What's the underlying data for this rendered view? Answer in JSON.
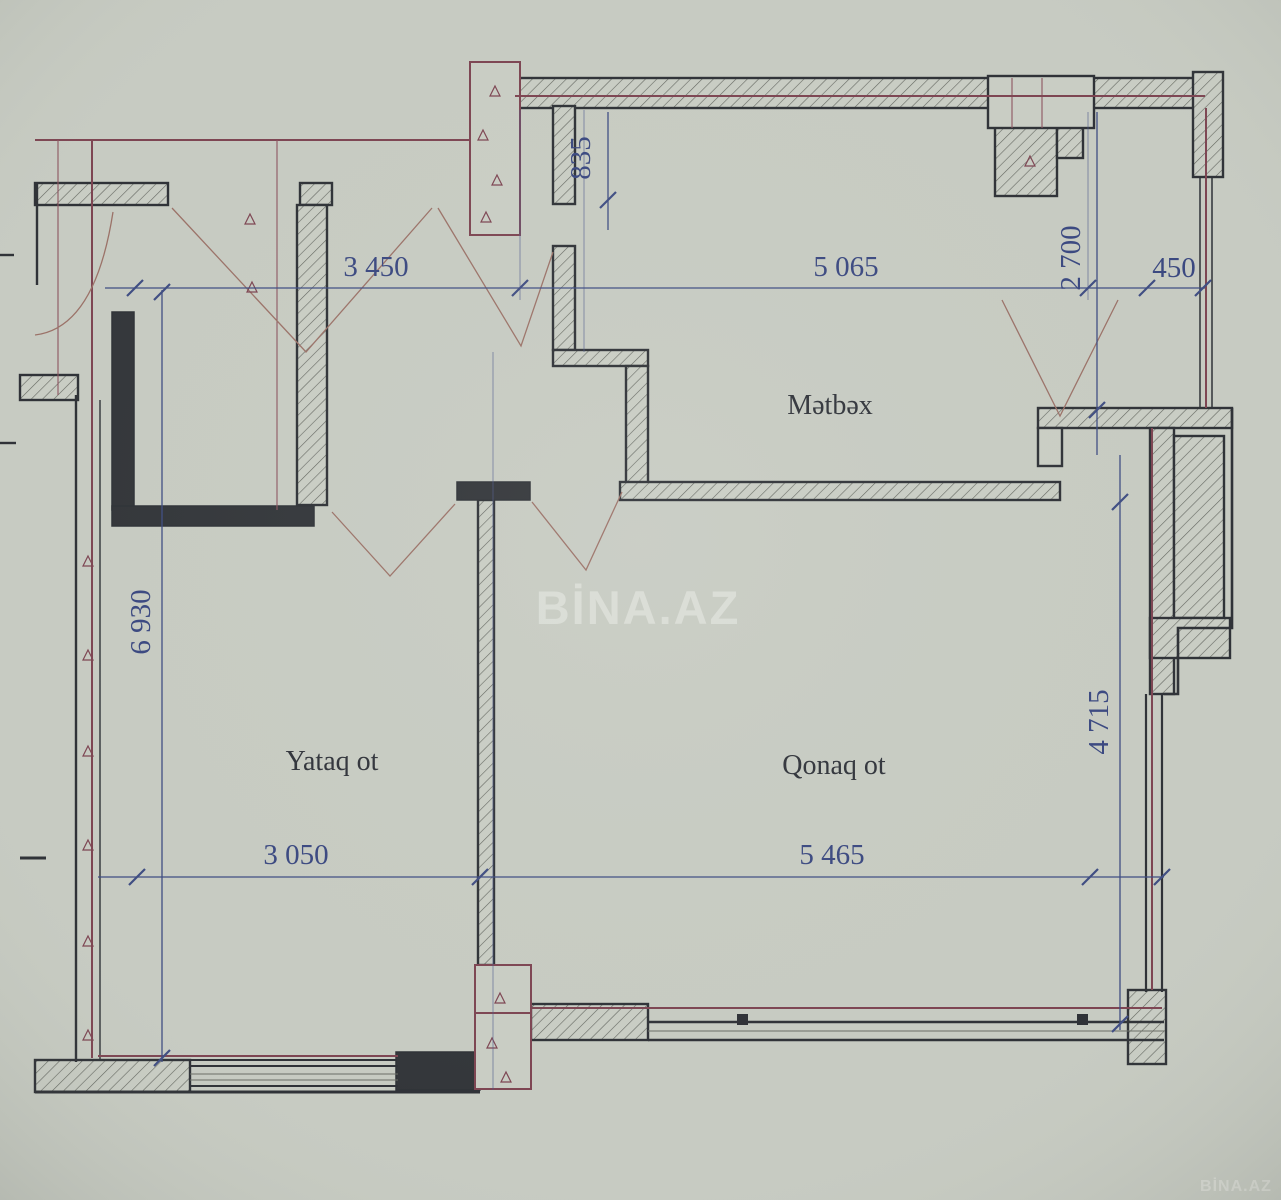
{
  "watermark": {
    "center": "BİNA.AZ",
    "corner": "BİNA.AZ"
  },
  "rooms": {
    "kitchen": "Mətbəx",
    "bedroom": "Yataq ot",
    "living": "Qonaq ot"
  },
  "dimensions": {
    "kitchen_wall_top_height": "835",
    "hall_width": "3 450",
    "kitchen_width": "5 065",
    "right_upper_height": "2 700",
    "right_upper_width": "450",
    "left_total_height": "6 930",
    "living_height": "4 715",
    "bedroom_width": "3 050",
    "living_width": "5 465"
  },
  "colors": {
    "paper": "#c7cbc2",
    "wall_ink": "#2f3237",
    "dimension_blue": "#3f4d82",
    "axis_red": "#7d4552",
    "watermark": "#eceee8"
  }
}
